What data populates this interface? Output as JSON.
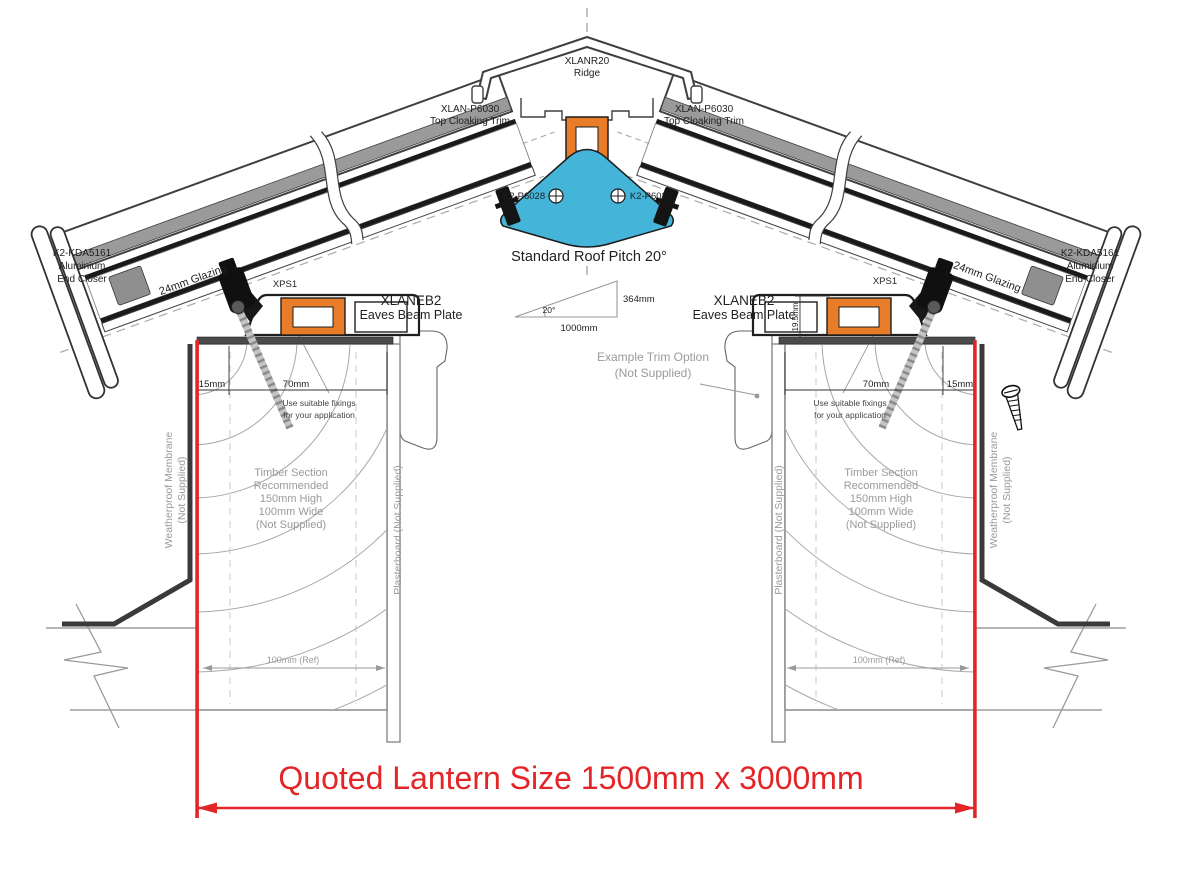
{
  "document": {
    "type": "technical-drawing",
    "subject": "Roof lantern cross section - ridge and eaves details"
  },
  "colors": {
    "accent_red": "#e42528",
    "profile_orange": "#e87c28",
    "profile_blue": "#45b4d9",
    "profile_dark": "#2a2a2a",
    "note_gray": "#9a9a9a",
    "line_gray": "#8a8a8a"
  },
  "ridge": {
    "code": "XLANR20",
    "label": "Ridge"
  },
  "cloaking": {
    "code": "XLAN-P6030",
    "label": "Top Cloaking Trim"
  },
  "glazing_bar": {
    "code": "K2-P6028"
  },
  "pitch": {
    "title": "Standard Roof Pitch 20°",
    "angle": "20°",
    "run": "1000mm",
    "rise": "364mm"
  },
  "end_closer": {
    "code": "K2-KDA5161",
    "material": "Aluminium",
    "label": "End Closer"
  },
  "glazing": {
    "label": "24mm Glazing"
  },
  "xps": {
    "code": "XPS1"
  },
  "eaves_beam": {
    "code": "XLANEB2",
    "label": "Eaves Beam Plate"
  },
  "dims": {
    "edge": "15mm",
    "seat": "70mm",
    "upstand": "19.5mm",
    "ref": "100mm (Ref)"
  },
  "notes": {
    "fixings1": "Use suitable fixings",
    "fixings2": "for your application",
    "trim1": "Example  Trim Option",
    "trim2": "(Not Supplied)",
    "timber1": "Timber Section",
    "timber2": "Recommended",
    "timber3": "150mm High",
    "timber4": "100mm Wide",
    "timber5": "(Not Supplied)",
    "membrane1": "Weatherproof Membrane",
    "membrane2": "(Not Supplied)",
    "plasterboard": "Plasterboard (Not Supplied)"
  },
  "quote": {
    "label": "Quoted Lantern Size 1500mm x 3000mm"
  }
}
